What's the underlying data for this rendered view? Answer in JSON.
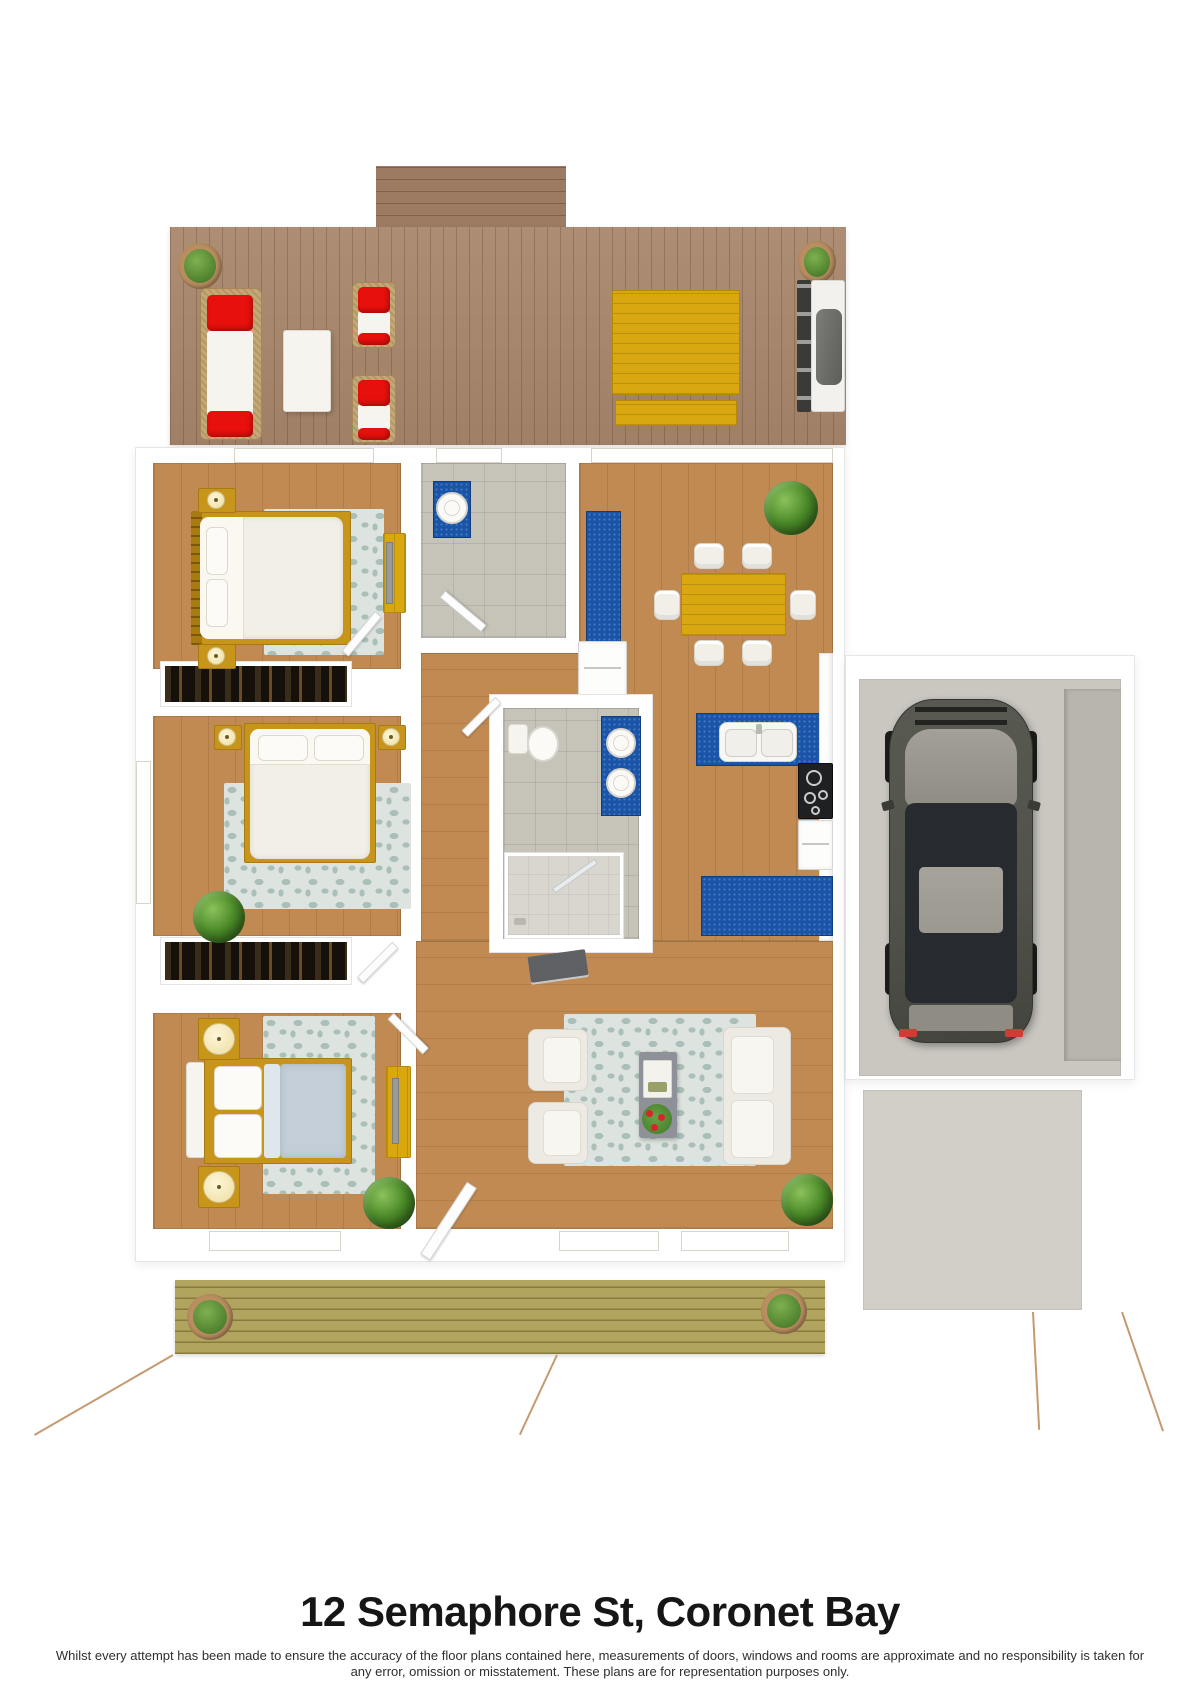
{
  "title": "12 Semaphore St, Coronet Bay",
  "disclaimer": {
    "line1": "Whilst every attempt has been made to ensure the accuracy of the floor plans contained here, measurements of doors, windows and rooms are approximate and no responsibility is taken for",
    "line2": "any error, omission or misstatement. These plans are for representation purposes only."
  },
  "colors": {
    "wall_white": "#ffffff",
    "wood_floor": "#c08a52",
    "tile_floor": "#c6c3b9",
    "deck_top": "#a8866b",
    "deck_steps": "#9d7b62",
    "deck_bottom": "#b1a45e",
    "counter_blue": "#1a54a6",
    "accent_yellow": "#d9a70f",
    "accent_gold": "#c8951b",
    "cushion_red": "#e8100c",
    "rug_base": "#dde3de",
    "rug_spot": "#abbfba",
    "mattress_white": "#f2efe7",
    "duvet_blue": "#c3ced8",
    "concrete_garage": "#cac7c0",
    "concrete_driveway": "#d2cfc8",
    "car_body": "#52534b",
    "car_roof": "#9b9890",
    "plant_green": "#4a8a28",
    "title_text": "#161616",
    "disclaimer_text": "#2f2f2f"
  }
}
